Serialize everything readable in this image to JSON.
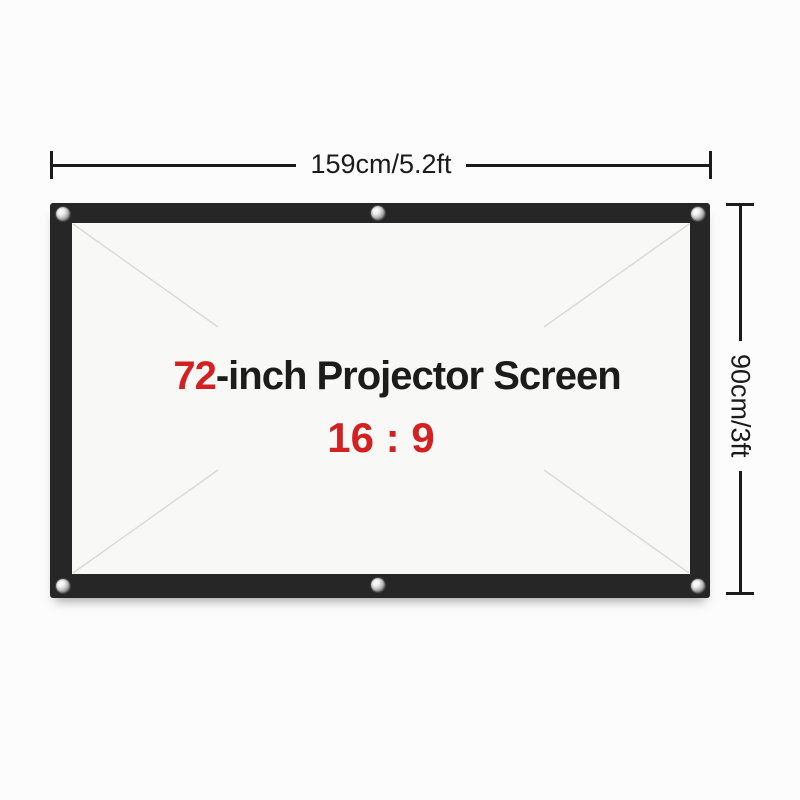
{
  "diagram": {
    "width_dimension": {
      "label": "159cm/5.2ft"
    },
    "height_dimension": {
      "label": "90cm/3ft"
    },
    "screen": {
      "size_value": "72",
      "title_suffix": "-inch Projector Screen",
      "aspect_ratio": "16 : 9",
      "grommet_icons": [
        "top-left",
        "top-center",
        "top-right",
        "bottom-left",
        "bottom-center",
        "bottom-right"
      ]
    },
    "colors": {
      "accent_red": "#d32020",
      "ink": "#1b1b1b",
      "frame_black": "#262626",
      "screen_surface": "#f8f8f6",
      "crease_gray": "#d9d9d6",
      "page_background": "#fcfcfc"
    }
  }
}
